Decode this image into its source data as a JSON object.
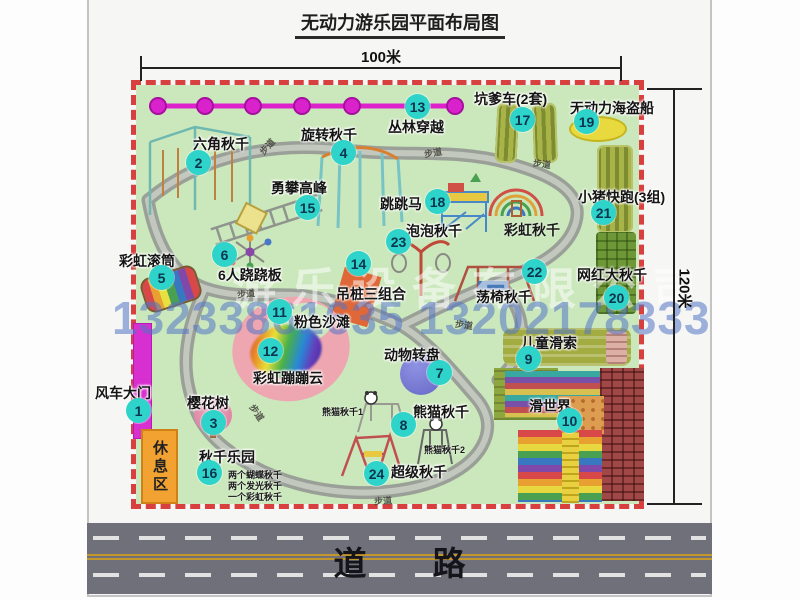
{
  "title": "无动力游乐园平面布局图",
  "dimensions": {
    "width_label": "100米",
    "height_label": "120米"
  },
  "road": {
    "label": "道　　路"
  },
  "watermark": {
    "company": "游乐设备有限公司",
    "phone": "13233861635 13202178333"
  },
  "rest_area": "休息区",
  "colors": {
    "map_green": "#cbe8bc",
    "border_red": "#d84040",
    "badge_teal": "#2ed3c9",
    "zipline_magenta": "#dd22cc",
    "road_gray": "#70707a",
    "rest_orange": "#f2a231",
    "watermark_blue": "#5274c4",
    "pink_beach": "#eea7b0"
  },
  "attractions": [
    {
      "num": "1",
      "label": "风车大门",
      "lx": 95,
      "ly": 383,
      "bx": 126,
      "by": 398
    },
    {
      "num": "2",
      "label": "六角秋千",
      "lx": 193,
      "ly": 134,
      "bx": 186,
      "by": 150
    },
    {
      "num": "3",
      "label": "樱花树",
      "lx": 187,
      "ly": 393,
      "bx": 201,
      "by": 410
    },
    {
      "num": "4",
      "label": "旋转秋千",
      "lx": 301,
      "ly": 125,
      "bx": 331,
      "by": 140
    },
    {
      "num": "5",
      "label": "彩虹滚筒",
      "lx": 119,
      "ly": 251,
      "bx": 149,
      "by": 265
    },
    {
      "num": "6",
      "label": "6人跷跷板",
      "lx": 218,
      "ly": 265,
      "bx": 212,
      "by": 242
    },
    {
      "num": "7",
      "label": "动物转盘",
      "lx": 384,
      "ly": 345,
      "bx": 427,
      "by": 360
    },
    {
      "num": "8",
      "label": "熊猫秋千",
      "lx": 413,
      "ly": 402,
      "bx": 391,
      "by": 412
    },
    {
      "num": "9",
      "label": "儿童滑索",
      "lx": 521,
      "ly": 333,
      "bx": 516,
      "by": 346
    },
    {
      "num": "10",
      "label": "滑世界",
      "lx": 529,
      "ly": 396,
      "bx": 557,
      "by": 408
    },
    {
      "num": "11",
      "label": "粉色沙滩",
      "lx": 294,
      "ly": 312,
      "bx": 267,
      "by": 299
    },
    {
      "num": "12",
      "label": "彩虹蹦蹦云",
      "lx": 253,
      "ly": 368,
      "bx": 258,
      "by": 338
    },
    {
      "num": "13",
      "label": "丛林穿越",
      "lx": 388,
      "ly": 117,
      "bx": 405,
      "by": 94
    },
    {
      "num": "14",
      "label": "吊桩三组合",
      "lx": 336,
      "ly": 284,
      "bx": 346,
      "by": 251
    },
    {
      "num": "15",
      "label": "勇攀高峰",
      "lx": 271,
      "ly": 178,
      "bx": 295,
      "by": 195
    },
    {
      "num": "16",
      "label": "秋千乐园",
      "lx": 199,
      "ly": 447,
      "bx": 197,
      "by": 460
    },
    {
      "num": "17",
      "label": "坑爹车(2套)",
      "lx": 474,
      "ly": 89,
      "bx": 510,
      "by": 107
    },
    {
      "num": "18",
      "label": "跳跳马",
      "lx": 380,
      "ly": 194,
      "bx": 425,
      "by": 189
    },
    {
      "num": "19",
      "label": "无动力海盗船",
      "lx": 570,
      "ly": 98,
      "bx": 574,
      "by": 109
    },
    {
      "num": "20",
      "label": "网红大秋千",
      "lx": 577,
      "ly": 265,
      "bx": 604,
      "by": 285
    },
    {
      "num": "21",
      "label": "小猪快跑(3组)",
      "lx": 578,
      "ly": 187,
      "bx": 591,
      "by": 200
    },
    {
      "num": "22",
      "label": "荡椅秋千",
      "lx": 476,
      "ly": 287,
      "bx": 522,
      "by": 259
    },
    {
      "num": "23",
      "label": "泡泡秋千",
      "lx": 406,
      "ly": 221,
      "bx": 386,
      "by": 229
    },
    {
      "num": "24",
      "label": "超级秋千",
      "lx": 391,
      "ly": 462,
      "bx": 364,
      "by": 461
    }
  ],
  "path_labels": [
    {
      "text": "步道",
      "x": 258,
      "y": 140,
      "rot": -48
    },
    {
      "text": "步道",
      "x": 424,
      "y": 146,
      "rot": -10
    },
    {
      "text": "步道",
      "x": 533,
      "y": 157,
      "rot": 8
    },
    {
      "text": "步道",
      "x": 237,
      "y": 287,
      "rot": -5
    },
    {
      "text": "步道",
      "x": 248,
      "y": 406,
      "rot": 55
    },
    {
      "text": "步道",
      "x": 455,
      "y": 318,
      "rot": 8
    },
    {
      "text": "步道",
      "x": 374,
      "y": 494,
      "rot": -4
    }
  ],
  "extra_labels": [
    {
      "text": "彩虹秋千",
      "x": 504,
      "y": 220,
      "size": 14
    },
    {
      "text": "熊猫秋千1",
      "x": 322,
      "y": 405,
      "size": 9
    },
    {
      "text": "熊猫秋千2",
      "x": 424,
      "y": 443,
      "size": 9
    },
    {
      "text": "两个蝴蝶秋千",
      "x": 228,
      "y": 468,
      "size": 9
    },
    {
      "text": "两个发光秋千",
      "x": 228,
      "y": 479,
      "size": 9
    },
    {
      "text": "一个彩虹秋千",
      "x": 228,
      "y": 490,
      "size": 9
    }
  ]
}
